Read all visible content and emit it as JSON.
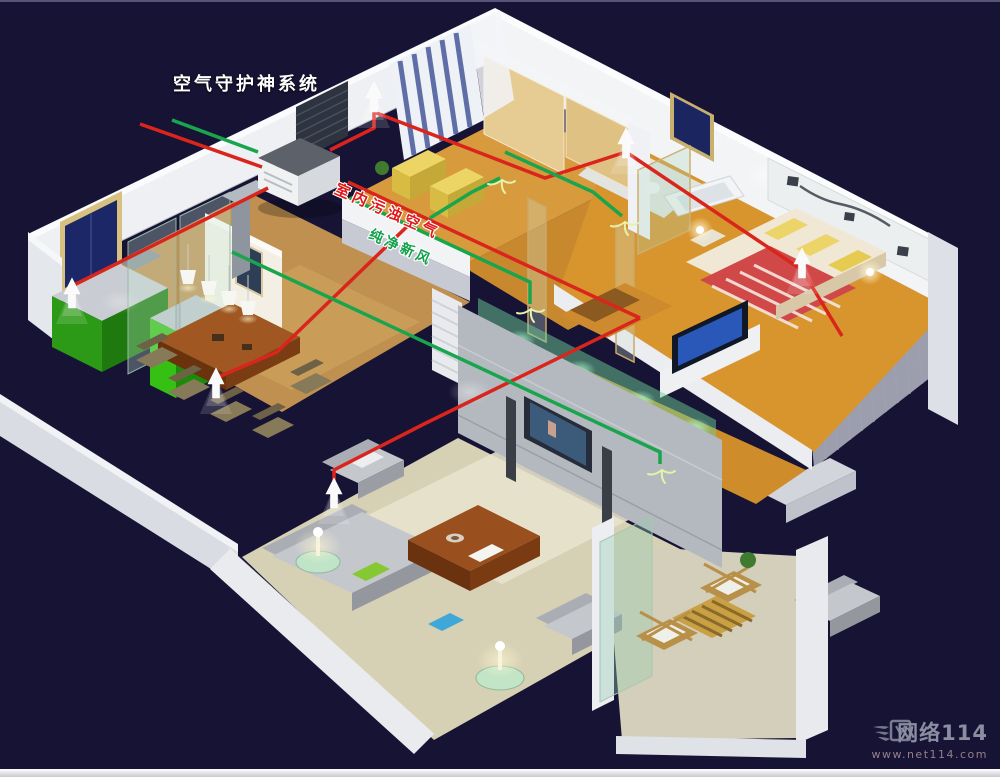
{
  "scene": {
    "background_color": "#171334",
    "top_border_color": "#55557a",
    "bottom_strip_color": "#e9e9ec"
  },
  "title": {
    "text": "空气守护神系统",
    "color": "#ffffff"
  },
  "flows": {
    "exhaust": {
      "label": "室内污浊空气",
      "color": "#da251d",
      "vent_icon": "up-arrow"
    },
    "fresh": {
      "label": "纯净新风",
      "color": "#18a54d",
      "vent_icon": "diffuser-fan"
    }
  },
  "watermark": {
    "site_name": "网络114",
    "site_url": "www.net114.com",
    "color": "#a9adbd"
  }
}
